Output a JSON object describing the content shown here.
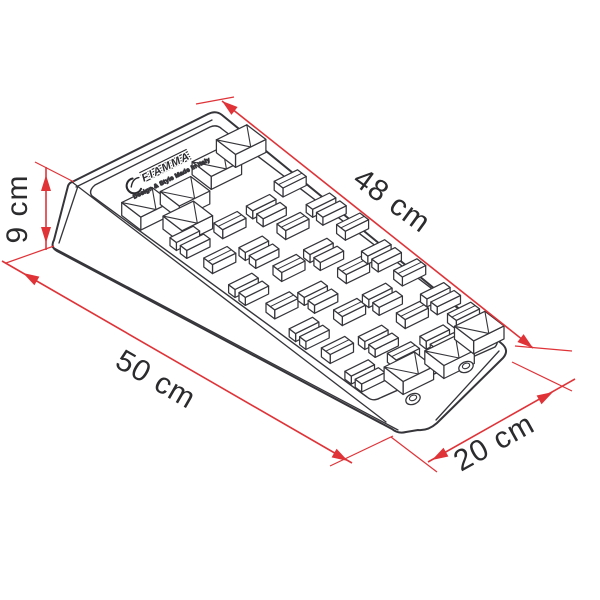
{
  "diagram": {
    "type": "product-dimension-line-drawing",
    "subject": "wedge-shaped leveling ramp shown in isometric view with anti-slip tread blocks",
    "logo": {
      "brand": "FIAMMA",
      "tagline": "Design & Style Made in Italy"
    },
    "dimensions": {
      "top_length": {
        "label": "48 cm"
      },
      "height": {
        "label": "9 cm"
      },
      "base_length": {
        "label": "50 cm"
      },
      "width": {
        "label": "20 cm"
      }
    },
    "colors": {
      "dimension_red": "#df3338",
      "line_dark": "#35353a",
      "background": "#ffffff",
      "label_text": "#2b2b2e"
    }
  }
}
